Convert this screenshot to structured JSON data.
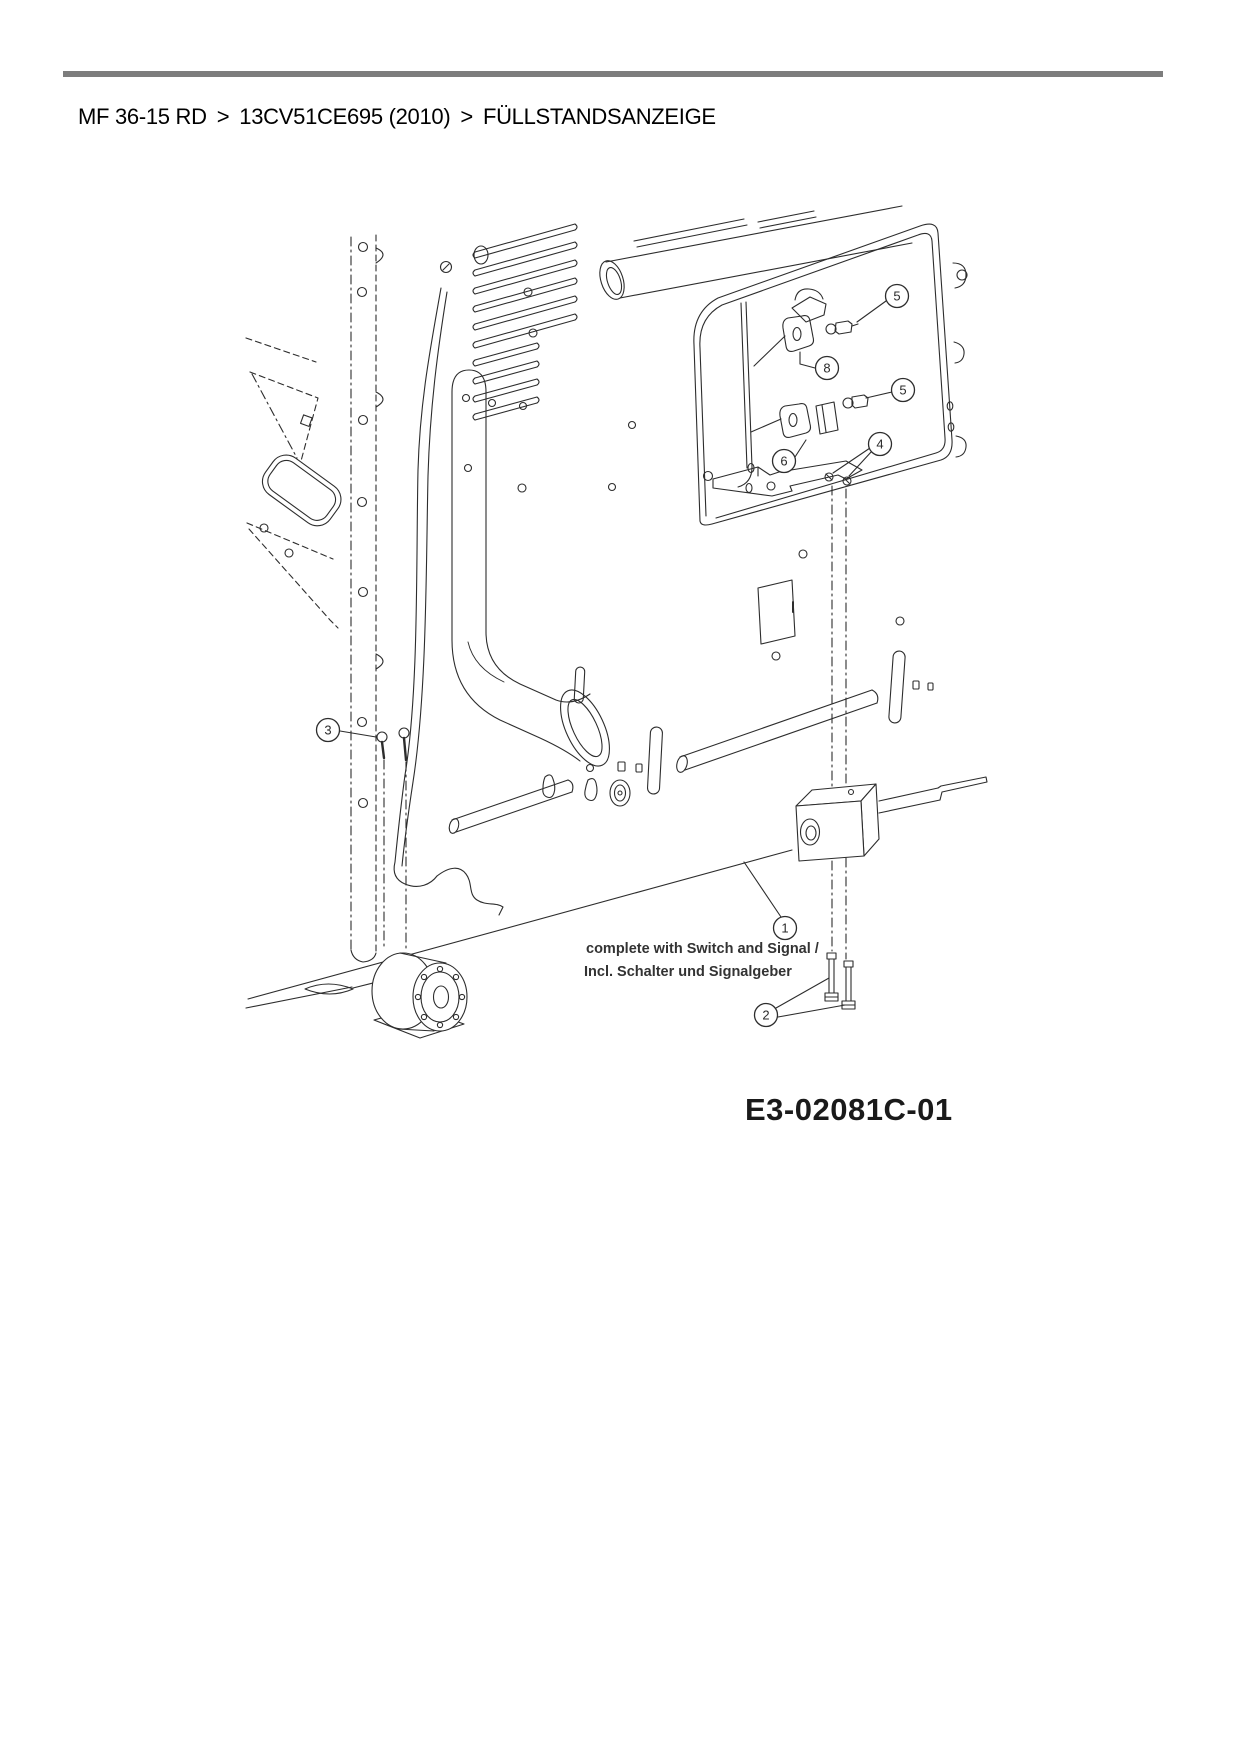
{
  "page": {
    "background": "#ffffff",
    "rule_color": "#7d7d7d"
  },
  "breadcrumb": {
    "model": "MF 36-15 RD",
    "separator": ">",
    "variant": "13CV51CE695 (2010)",
    "section": "FÜLLSTANDSANZEIGE"
  },
  "diagram": {
    "note_line1": "complete with Switch and Signal /",
    "note_line2": "Incl. Schalter und Signalgeber",
    "drawing_number": "E3-02081C-01",
    "line_color": "#2d2d2d",
    "callouts": [
      {
        "label": "5",
        "x": 897,
        "y": 296
      },
      {
        "label": "8",
        "x": 827,
        "y": 368
      },
      {
        "label": "5",
        "x": 903,
        "y": 390
      },
      {
        "label": "6",
        "x": 784,
        "y": 461
      },
      {
        "label": "4",
        "x": 880,
        "y": 444
      },
      {
        "label": "3",
        "x": 328,
        "y": 730
      },
      {
        "label": "1",
        "x": 785,
        "y": 928
      },
      {
        "label": "2",
        "x": 766,
        "y": 1015
      }
    ]
  }
}
